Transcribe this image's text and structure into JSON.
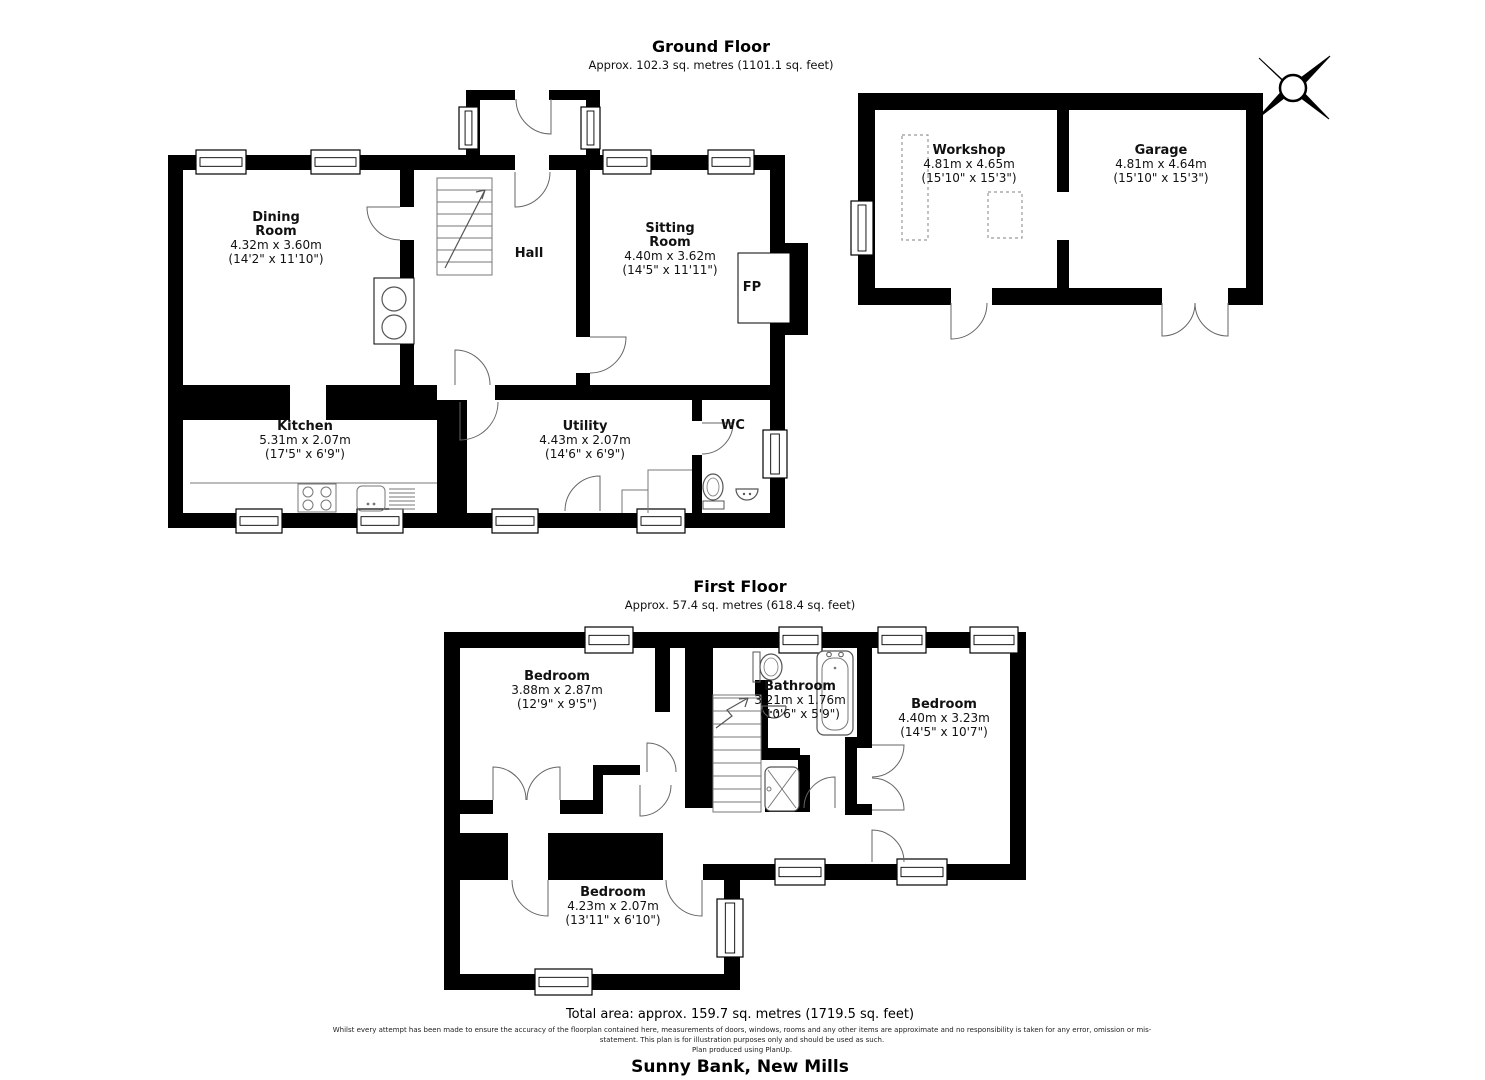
{
  "ground_floor": {
    "title": "Ground Floor",
    "subtitle": "Approx. 102.3 sq. metres (1101.1 sq. feet)",
    "rooms": {
      "dining": {
        "name": "Dining Room",
        "dim_m": "4.32m x 3.60m",
        "dim_ft": "(14'2\" x 11'10\")"
      },
      "hall": {
        "name": "Hall"
      },
      "sitting": {
        "name": "Sitting Room",
        "dim_m": "4.40m x 3.62m",
        "dim_ft": "(14'5\" x 11'11\")"
      },
      "fireplace": {
        "name": "FP"
      },
      "kitchen": {
        "name": "Kitchen",
        "dim_m": "5.31m x 2.07m",
        "dim_ft": "(17'5\" x 6'9\")"
      },
      "utility": {
        "name": "Utility",
        "dim_m": "4.43m x 2.07m",
        "dim_ft": "(14'6\" x 6'9\")"
      },
      "wc": {
        "name": "WC"
      },
      "workshop": {
        "name": "Workshop",
        "dim_m": "4.81m x 4.65m",
        "dim_ft": "(15'10\" x 15'3\")"
      },
      "garage": {
        "name": "Garage",
        "dim_m": "4.81m x 4.64m",
        "dim_ft": "(15'10\" x 15'3\")"
      }
    }
  },
  "first_floor": {
    "title": "First Floor",
    "subtitle": "Approx. 57.4 sq. metres (618.4 sq. feet)",
    "rooms": {
      "bedroom1": {
        "name": "Bedroom",
        "dim_m": "3.88m x 2.87m",
        "dim_ft": "(12'9\" x 9'5\")"
      },
      "bathroom": {
        "name": "Bathroom",
        "dim_m": "3.21m x 1.76m",
        "dim_ft": "(10'6\" x 5'9\")"
      },
      "bedroom2": {
        "name": "Bedroom",
        "dim_m": "4.40m x 3.23m",
        "dim_ft": "(14'5\" x 10'7\")"
      },
      "bedroom3": {
        "name": "Bedroom",
        "dim_m": "4.23m x 2.07m",
        "dim_ft": "(13'11\" x 6'10\")"
      }
    }
  },
  "footer": {
    "total_area": "Total area: approx. 159.7 sq. metres (1719.5 sq. feet)",
    "disclaimer_line1": "Whilst every attempt has been made to ensure the accuracy of the floorplan contained here, measurements of doors, windows, rooms and any other items are approximate and no responsibility is taken for any error, omission or mis-",
    "disclaimer_line2": "statement. This plan is for illustration purposes only and should be used as such.",
    "disclaimer_line3": "Plan produced using PlanUp.",
    "property_name": "Sunny Bank, New Mills"
  },
  "colors": {
    "wall": "#000000",
    "background": "#ffffff",
    "fixture_line": "#666666"
  }
}
